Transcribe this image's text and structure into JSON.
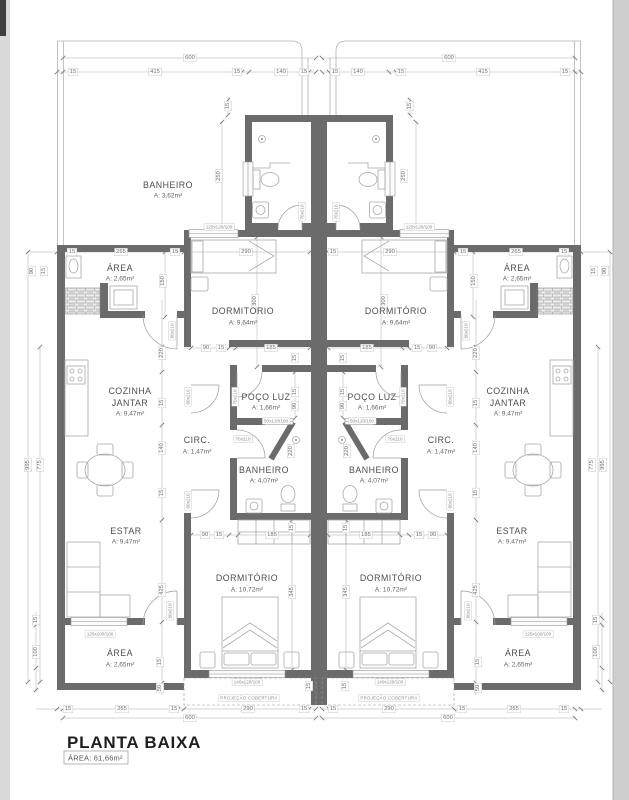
{
  "title": {
    "label": "PLANTA BAIXA",
    "area_line": "ÁREA:  61,66m²"
  },
  "rooms": {
    "banheiro_sup": {
      "name": "BANHEIRO",
      "area": "A: 3,62m²"
    },
    "area_sup": {
      "name": "ÁREA",
      "area": "A: 2,65m²"
    },
    "dorm_sup": {
      "name": "DORMITÓRIO",
      "area": "A: 9,64m²"
    },
    "cozinha": {
      "name1": "COZINHA",
      "name2": "JANTAR",
      "area": "A: 9,47m²"
    },
    "poco": {
      "name": "POÇO LUZ",
      "area": "A: 1,66m²"
    },
    "circ": {
      "name": "CIRC.",
      "area": "A: 1,47m²"
    },
    "banheiro": {
      "name": "BANHEIRO",
      "area": "A: 4,07m²"
    },
    "estar": {
      "name": "ESTAR",
      "area": "A: 9,47m²"
    },
    "dorm_inf": {
      "name": "DORMITÓRIO",
      "area": "A: 10,72m²"
    },
    "area_inf": {
      "name": "ÁREA",
      "area": "A: 2,65m²"
    }
  },
  "openings": {
    "door70": "70x210",
    "door80": "80x210",
    "win_dorm_sup": "125x120/100",
    "win_poco": "50x120/100",
    "win_dorm_inf": "140x120/100",
    "win_estar": "125x100/100"
  },
  "dims": {
    "d600": "600",
    "d415": "415",
    "d265": "265",
    "d290": "290",
    "d250": "250",
    "d300": "300",
    "d345": "345",
    "d425": "425",
    "d185": "185",
    "d150": "150",
    "d140": "140",
    "d220": "220",
    "d100": "100",
    "d995": "995",
    "d775": "775",
    "d90": "90",
    "d50": "50",
    "d15": "15"
  },
  "notes": {
    "projecao": "PROJEÇÃO  COBERTURA"
  }
}
